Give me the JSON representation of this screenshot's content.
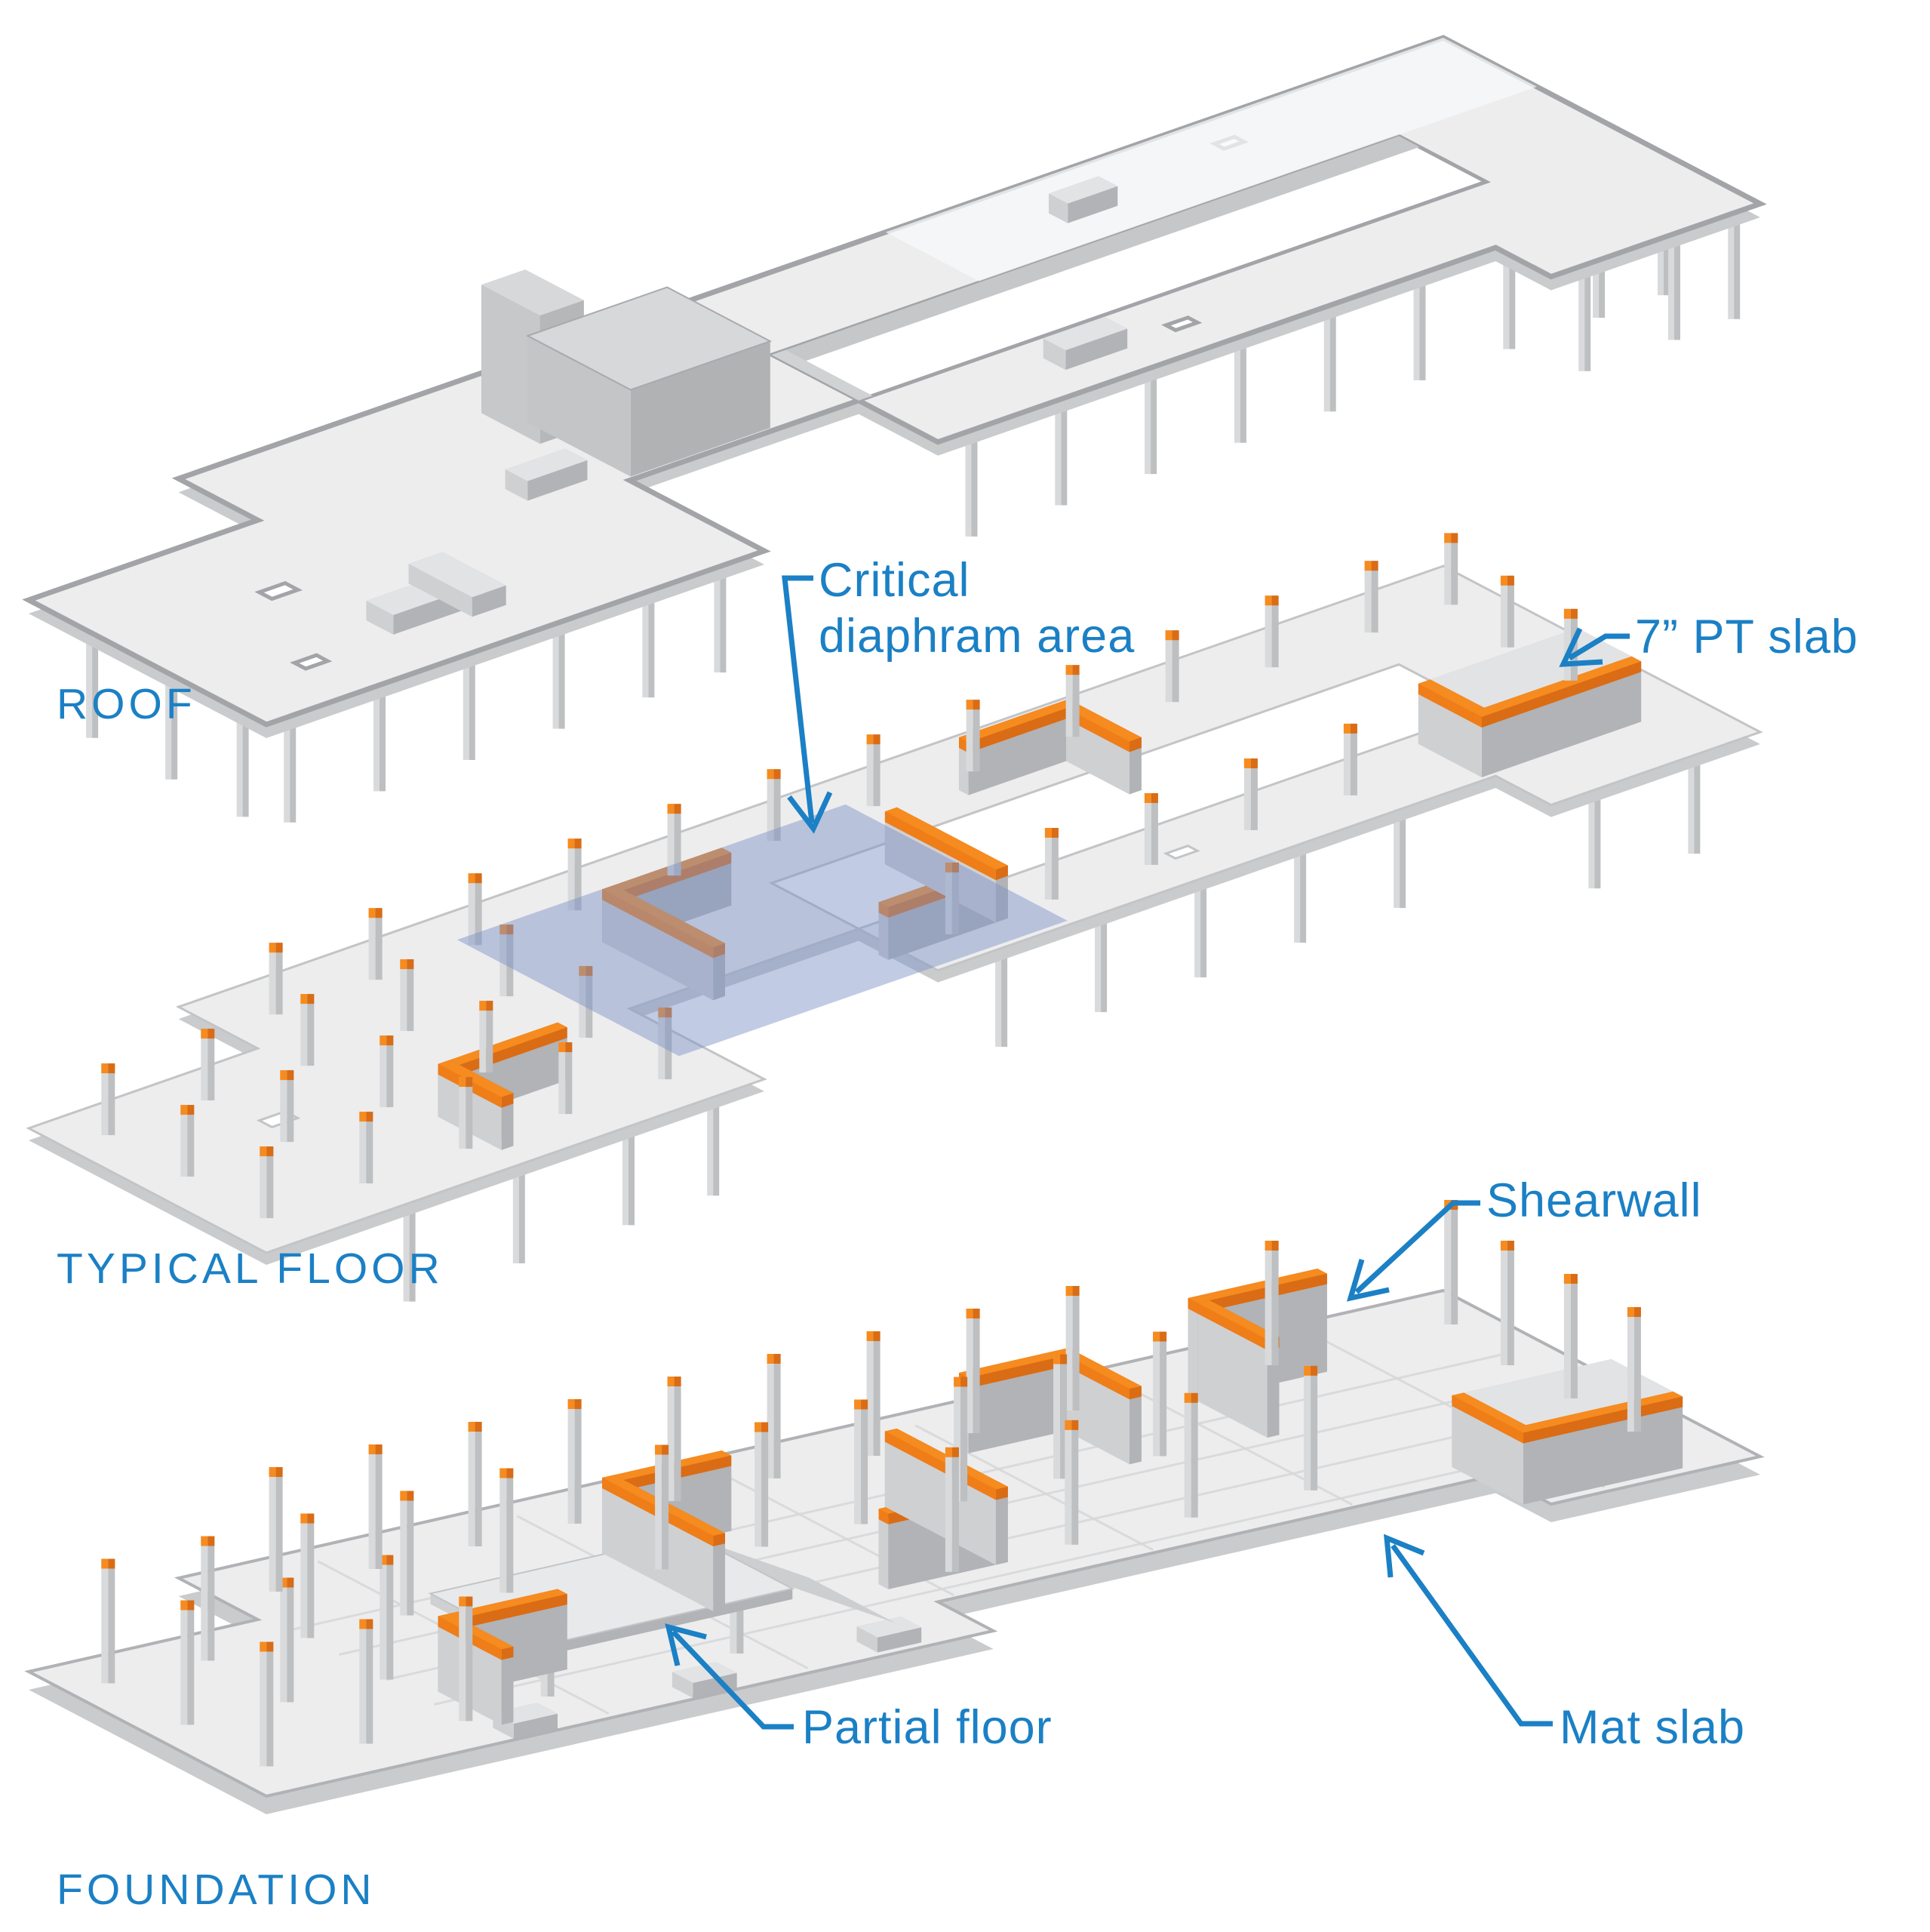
{
  "colors": {
    "label_blue": "#1b80c5",
    "orange": "#f68b1f",
    "orange_mid": "#ef7d18",
    "orange_dark": "#d96c15",
    "slab_top": "#ededee",
    "slab_side": "#c9cbcd",
    "slab_edge": "#a8aaad",
    "parapet": "#a2a4a7",
    "inner_wall": "#c5c7c9",
    "inner_wall2": "#d0d2d4",
    "col_light": "#d9dadb",
    "col_dark": "#bdbfc1",
    "side_light": "#cfd0d2",
    "side_dark": "#b1b3b6",
    "core_top": "#d4d5d7",
    "box_top": "#e2e3e5",
    "roofbox_top": "#d7d8da",
    "ramp": "#cdced0",
    "rib": "#d6d7d9",
    "overlay_blue": "#7e93c6",
    "background": "#ffffff"
  },
  "levels": [
    {
      "id": "roof",
      "label": "ROOF"
    },
    {
      "id": "typical-floor",
      "label": "TYPICAL FLOOR"
    },
    {
      "id": "foundation",
      "label": "FOUNDATION"
    }
  ],
  "annotations": [
    {
      "id": "critical-diaphragm-area",
      "lines": [
        "Critical",
        "diaphram area"
      ]
    },
    {
      "id": "pt-slab",
      "lines": [
        "7” PT slab"
      ]
    },
    {
      "id": "shearwall",
      "lines": [
        "Shearwall"
      ]
    },
    {
      "id": "partial-floor",
      "lines": [
        "Partial floor"
      ]
    },
    {
      "id": "mat-slab",
      "lines": [
        "Mat slab"
      ]
    }
  ]
}
